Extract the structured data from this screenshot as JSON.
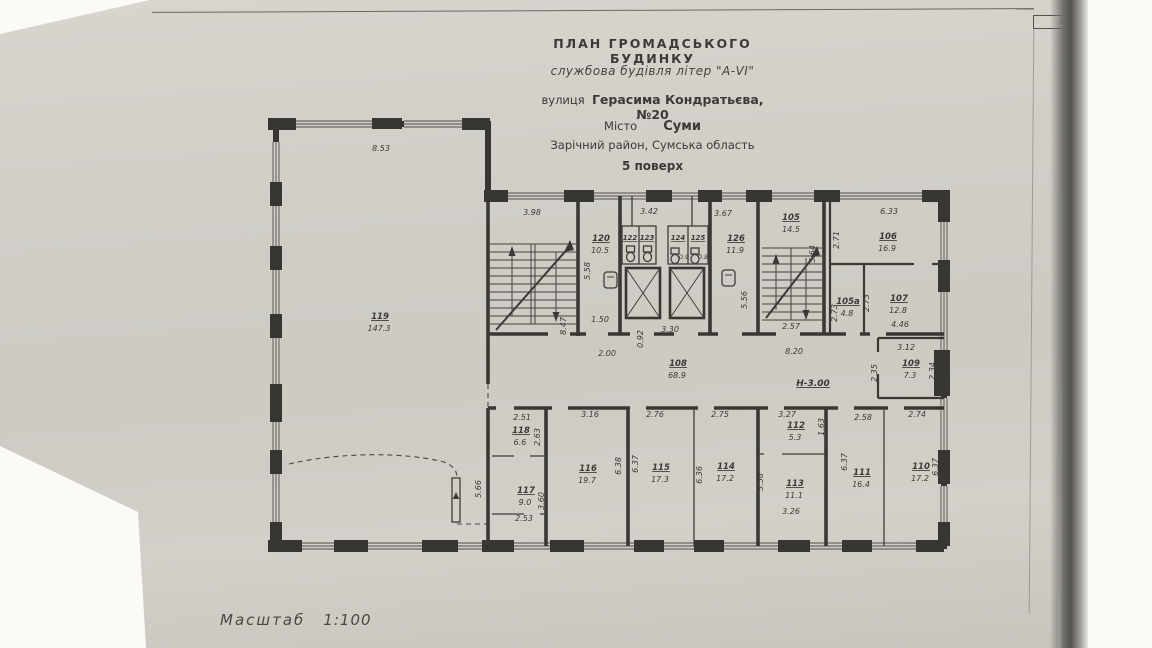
{
  "page": {
    "corner_number": "8"
  },
  "title_block": {
    "line1": "ПЛАН  ГРОМАДСЬКОГО  БУДИНКУ",
    "line2": "службова будівля літер \"А-VI\"",
    "line3_prefix": "вулиця",
    "line3_value": "Герасима Кондратьєва, №20",
    "line4_prefix": "Місто",
    "line4_value": "Суми",
    "line5": "Зарічний район, Сумська область",
    "line6": "5 поверх"
  },
  "scale": {
    "label": "Масштаб",
    "value": "1:100"
  },
  "elevation_note": "Н-3.00",
  "rooms": {
    "r119": {
      "number": "119",
      "area": "147.3"
    },
    "r120": {
      "number": "120",
      "area": "10.5"
    },
    "r122": {
      "number": "122",
      "area": ""
    },
    "r123": {
      "number": "123",
      "area": ""
    },
    "r124": {
      "number": "124",
      "area": "0.9"
    },
    "r125": {
      "number": "125",
      "area": "0.8"
    },
    "r126": {
      "number": "126",
      "area": "11.9"
    },
    "r105": {
      "number": "105",
      "area": "14.5"
    },
    "r105a": {
      "number": "105а",
      "area": "4.8"
    },
    "r106": {
      "number": "106",
      "area": "16.9"
    },
    "r107": {
      "number": "107",
      "area": "12.8"
    },
    "r108": {
      "number": "108",
      "area": "68.9"
    },
    "r109": {
      "number": "109",
      "area": "7.3"
    },
    "r110": {
      "number": "110",
      "area": "17.2"
    },
    "r111": {
      "number": "111",
      "area": "16.4"
    },
    "r112": {
      "number": "112",
      "area": "5.3"
    },
    "r113": {
      "number": "113",
      "area": "11.1"
    },
    "r114": {
      "number": "114",
      "area": "17.2"
    },
    "r115": {
      "number": "115",
      "area": "17.3"
    },
    "r116": {
      "number": "116",
      "area": "19.7"
    },
    "r117": {
      "number": "117",
      "area": "9.0"
    },
    "r118": {
      "number": "118",
      "area": "6.6"
    }
  },
  "dims": {
    "r119_top": "8.53",
    "r119_stub": "5.66",
    "stair1_top": "3.98",
    "stair1_side": "8.47",
    "r120_top": "3.42",
    "r120_side": "5.58",
    "r120_door": "1.50",
    "bay126_top": "3.67",
    "r126_side": "5.56",
    "elev_top": "3.30",
    "elev_side": "0.92",
    "corr_left": "2.00",
    "corr_right": "8.20",
    "stair2_bottom": "2.57",
    "stair2_side": "5.64",
    "stair2_right": "2.71",
    "r106_top": "6.33",
    "r105a_side": "2.73",
    "r107_side": "2.73",
    "r107_bottom": "4.46",
    "r109_top": "3.12",
    "r109_left": "2.35",
    "r109_right": "2.34",
    "r110_top": "2.74",
    "r110_side": "6.37",
    "r111_top": "2.58",
    "r111_side": "6.37",
    "r112_top": "3.27",
    "r112_side": "1.63",
    "r113_side": "3.58",
    "r113_bottom": "3.26",
    "r114_top": "2.75",
    "r114_side": "6.36",
    "r115_top": "2.76",
    "r115_side": "6.37",
    "r116_top": "3.16",
    "r116_side": "6.38",
    "r117_bottom": "2.53",
    "r117_side": "3.60",
    "r118_top": "2.51",
    "r118_side": "2.63"
  },
  "colors": {
    "paper": "#d1cec8",
    "ink": "#32302c",
    "photo_shadow": "#56544f",
    "background": "#fbfaf7"
  }
}
